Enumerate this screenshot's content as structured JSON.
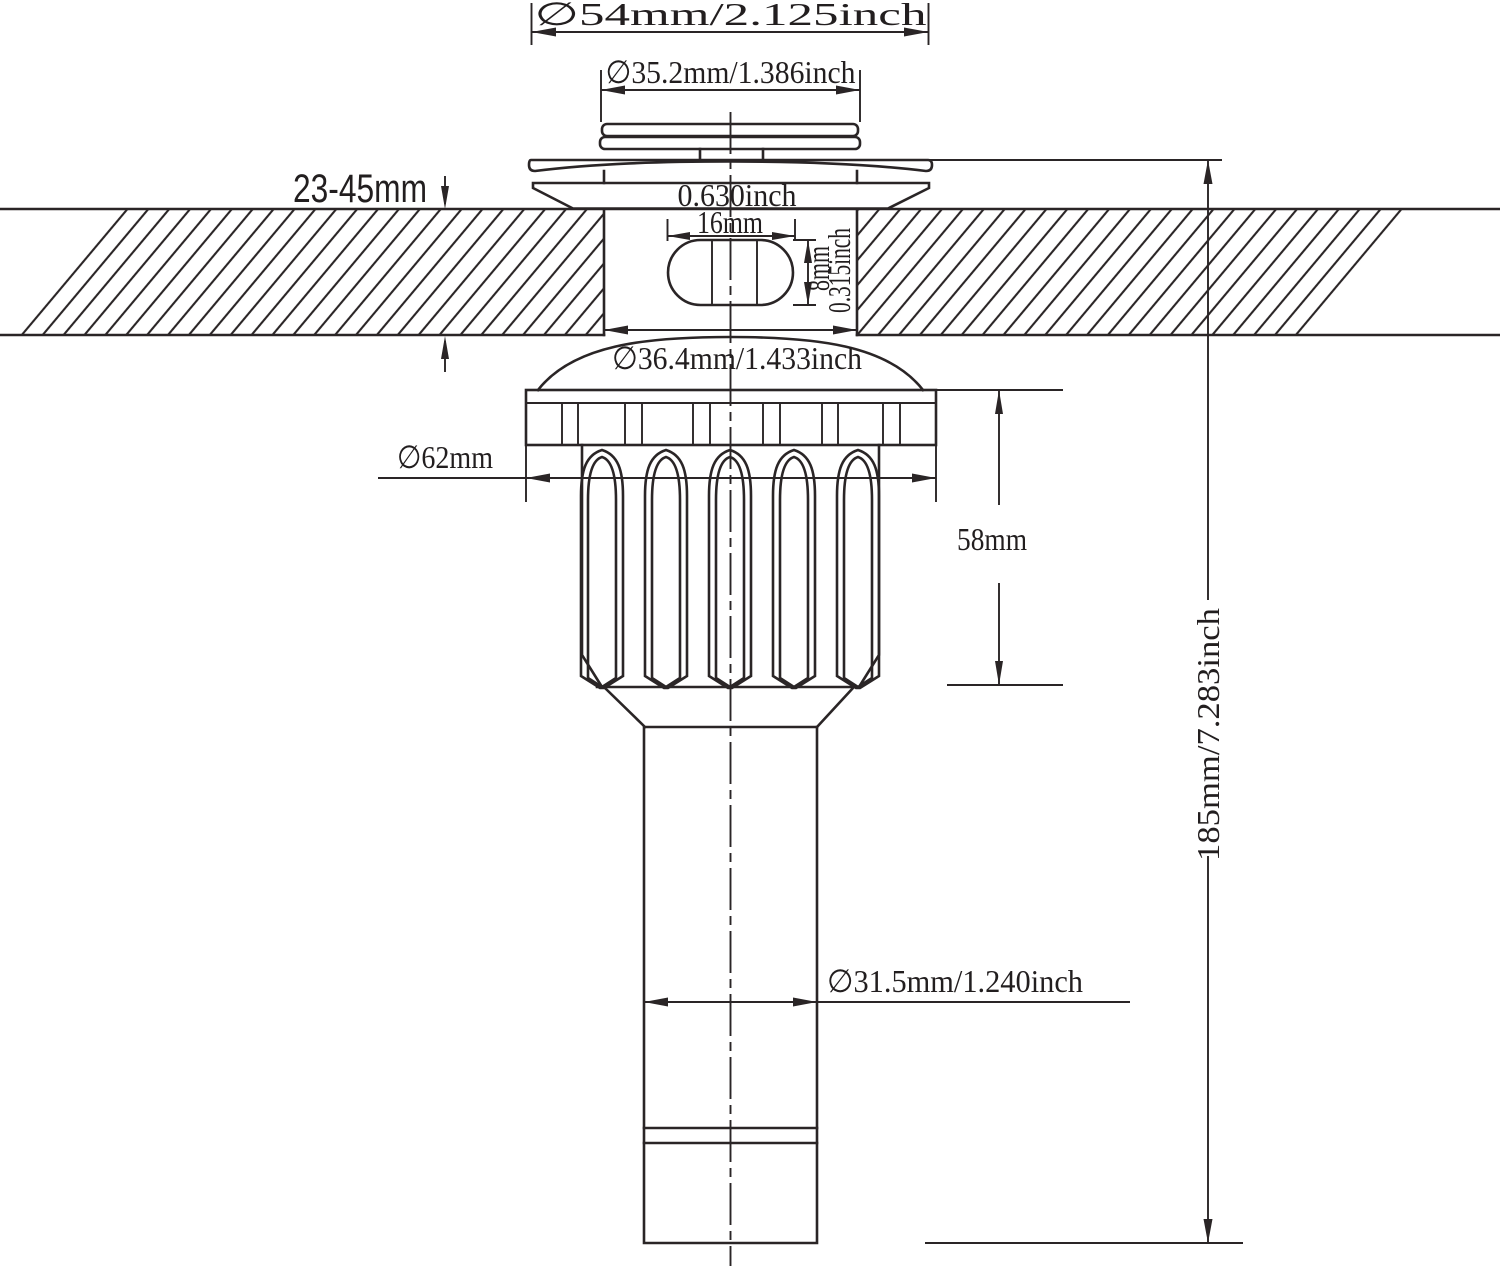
{
  "drawing": {
    "background": "#ffffff",
    "line_color": "#2a2526",
    "labels": {
      "top_flange_diameter": "∅54mm/2.125inch",
      "cap_diameter": "∅35.2mm/1.386inch",
      "countertop_thickness": "23-45mm",
      "slot_length_inch": "0.630inch",
      "slot_length_mm": "16mm",
      "slot_height_mm": "8mm",
      "slot_height_inch": "0.315inch",
      "body_diameter": "∅36.4mm/1.433inch",
      "lock_nut_diameter": "∅62mm",
      "lock_nut_height": "58mm",
      "tail_pipe_diameter": "∅31.5mm/1.240inch",
      "overall_height": "185mm/7.283inch"
    }
  }
}
